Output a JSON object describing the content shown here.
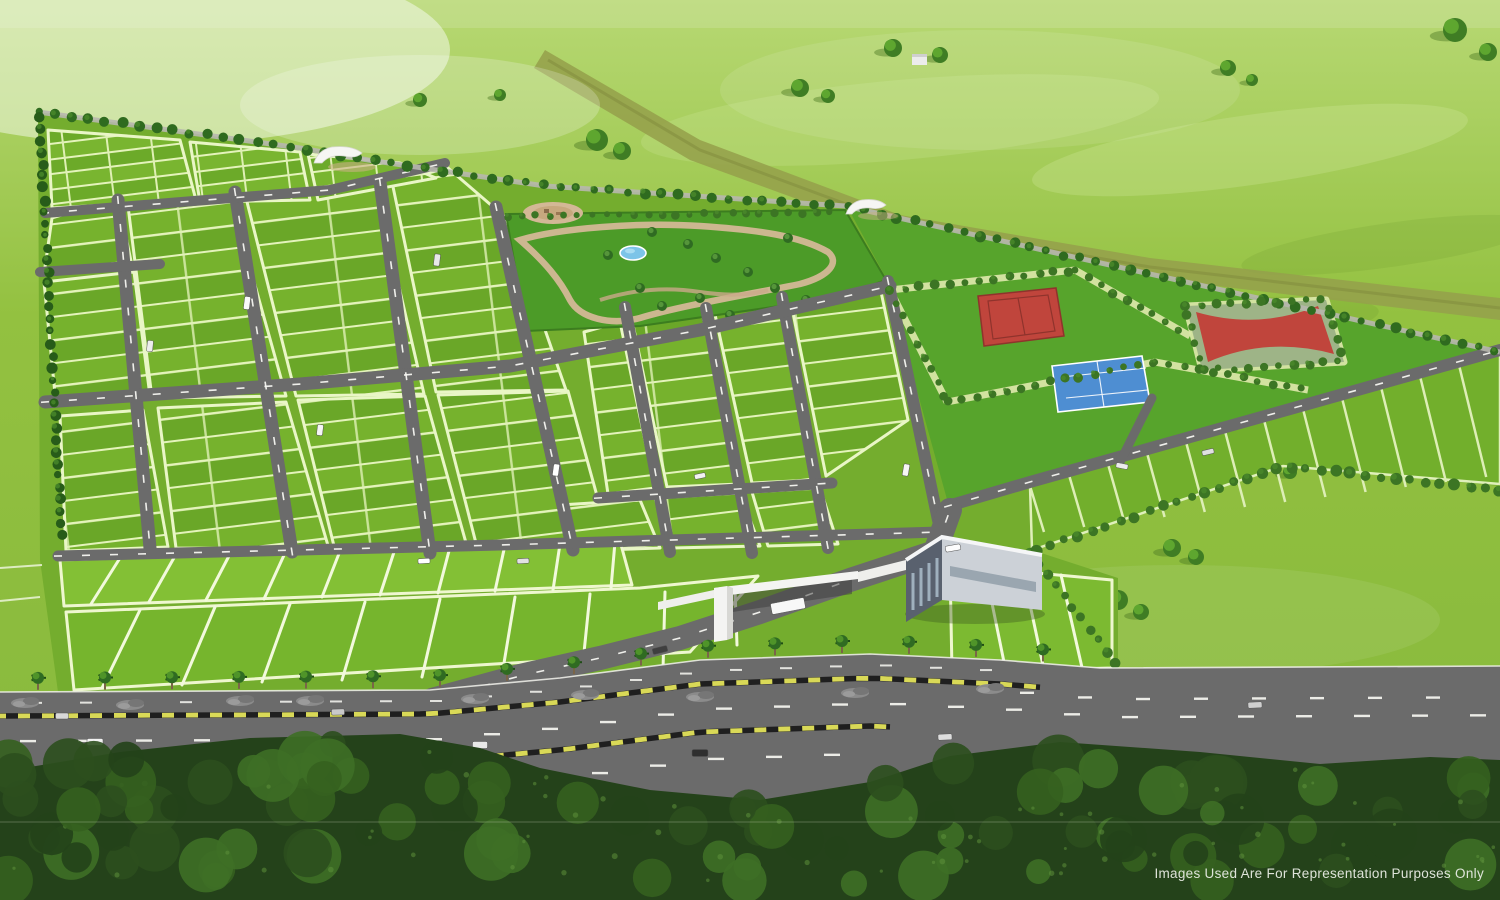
{
  "footer": {
    "disclaimer": "Images Used Are For Representation Purposes Only"
  },
  "palette": {
    "field_top": "#b7d873",
    "field_mid": "#93c140",
    "field_low": "#86b83c",
    "estate_lawn": "#74ad2e",
    "plot_green_a": "#76b22d",
    "plot_green_b": "#6aa728",
    "plot_line": "#e4f3bb",
    "front_plot_a": "#83c035",
    "front_plot_b": "#76b52d",
    "front_plot_c": "#7cba31",
    "se_plot": "#72af2c",
    "road": "#6b6b6b",
    "road_line": "#f7f7f2",
    "boundary_road": "#b7b7ae",
    "boundary_tree": "#2f6b1f",
    "conifer": "#275c19",
    "hedge": "#3c7524",
    "park_green": "#4c9b28",
    "courts_lawn": "#57a42c",
    "path_tan": "#d3b896",
    "plaza_tan": "#c7a87e",
    "pond_blue": "#7cc4e8",
    "court_red": "#c0453c",
    "court_blue": "#4e8ed2",
    "court_rim": "#9eb487",
    "khaki_path": "#d9e6a6",
    "gate_white": "#f4f4f2",
    "clubhouse_dark": "#59616e",
    "clubhouse_light": "#ccd1d7",
    "median_yellow": "#d9d957",
    "median_black": "#1f1f1f",
    "palm_dark": "#2f6b22",
    "palm_light": "#4f9429",
    "trunk": "#7a6548",
    "dirt_band": "#95a04b",
    "forest_0": "#24421a",
    "forest_1": "#2c4f1e",
    "forest_2": "#35611f",
    "forest_3": "#3e6f26",
    "forest_speckle": "#5d8f3b",
    "disclaimer_text": "#e8ece4"
  },
  "scenery": {
    "field_trees": [
      [
        100,
        222,
        10
      ],
      [
        116,
        231,
        8
      ],
      [
        420,
        100,
        7
      ],
      [
        597,
        140,
        11
      ],
      [
        622,
        151,
        9
      ],
      [
        800,
        88,
        9
      ],
      [
        828,
        96,
        7
      ],
      [
        893,
        48,
        9
      ],
      [
        940,
        55,
        8
      ],
      [
        1228,
        68,
        8
      ],
      [
        1252,
        80,
        6
      ],
      [
        1455,
        30,
        12
      ],
      [
        1488,
        52,
        9
      ],
      [
        762,
        296,
        8
      ],
      [
        783,
        304,
        7
      ],
      [
        893,
        284,
        8
      ],
      [
        938,
        333,
        8
      ],
      [
        1118,
        600,
        10
      ],
      [
        1141,
        612,
        8
      ],
      [
        1172,
        548,
        9
      ],
      [
        1196,
        557,
        8
      ],
      [
        1290,
        472,
        7
      ],
      [
        500,
        95,
        6
      ]
    ],
    "park_palms": [
      [
        652,
        232
      ],
      [
        688,
        244
      ],
      [
        716,
        258
      ],
      [
        748,
        272
      ],
      [
        775,
        288
      ],
      [
        700,
        298
      ],
      [
        662,
        306
      ],
      [
        640,
        288
      ],
      [
        788,
        238
      ],
      [
        806,
        300
      ],
      [
        730,
        315
      ],
      [
        608,
        255
      ]
    ],
    "roads": [
      {
        "pts": [
          [
            118,
            200
          ],
          [
            150,
            548
          ]
        ],
        "w": 13,
        "dash": true
      },
      {
        "pts": [
          [
            235,
            192
          ],
          [
            292,
            552
          ]
        ],
        "w": 13,
        "dash": true
      },
      {
        "pts": [
          [
            380,
            182
          ],
          [
            430,
            553
          ]
        ],
        "w": 13,
        "dash": true
      },
      {
        "pts": [
          [
            496,
            207
          ],
          [
            573,
            550
          ]
        ],
        "w": 13,
        "dash": true
      },
      {
        "pts": [
          [
            625,
            307
          ],
          [
            670,
            552
          ]
        ],
        "w": 12,
        "dash": true
      },
      {
        "pts": [
          [
            706,
            308
          ],
          [
            752,
            553
          ]
        ],
        "w": 12,
        "dash": true
      },
      {
        "pts": [
          [
            782,
            297
          ],
          [
            828,
            548
          ]
        ],
        "w": 12,
        "dash": true
      },
      {
        "pts": [
          [
            888,
            281
          ],
          [
            938,
            520
          ]
        ],
        "w": 12,
        "dash": true
      },
      {
        "pts": [
          [
            45,
            213
          ],
          [
            330,
            190
          ],
          [
            445,
            163
          ]
        ],
        "w": 10,
        "dash": true
      },
      {
        "pts": [
          [
            40,
            272
          ],
          [
            160,
            264
          ]
        ],
        "w": 10,
        "dash": false
      },
      {
        "pts": [
          [
            45,
            402
          ],
          [
            300,
            384
          ],
          [
            510,
            366
          ],
          [
            700,
            330
          ],
          [
            890,
            286
          ]
        ],
        "w": 13,
        "dash": true
      },
      {
        "pts": [
          [
            598,
            498
          ],
          [
            832,
            483
          ]
        ],
        "w": 11,
        "dash": true
      },
      {
        "pts": [
          [
            58,
            556
          ],
          [
            500,
            545
          ],
          [
            940,
            532
          ]
        ],
        "w": 11,
        "dash": true
      },
      {
        "pts": [
          [
            948,
            506
          ],
          [
            1030,
            482
          ],
          [
            1500,
            350
          ]
        ],
        "w": 12,
        "dash": true
      },
      {
        "pts": [
          [
            1152,
            398
          ],
          [
            1120,
            462
          ]
        ],
        "w": 9,
        "dash": false
      },
      {
        "pts": [
          [
            432,
            700
          ],
          [
            520,
            676
          ],
          [
            600,
            658
          ],
          [
            680,
            638
          ],
          [
            760,
            612
          ],
          [
            850,
            580
          ],
          [
            935,
            552
          ],
          [
            950,
            510
          ]
        ],
        "w": 24,
        "dash": true
      }
    ],
    "boundary_road": [
      [
        38,
        112
      ],
      [
        300,
        148
      ],
      [
        368,
        160
      ],
      [
        545,
        186
      ],
      [
        845,
        206
      ],
      [
        1500,
        352
      ]
    ],
    "hedgerows": [
      {
        "pts": [
          [
            38,
            112
          ],
          [
            300,
            148
          ],
          [
            368,
            160
          ],
          [
            545,
            186
          ],
          [
            845,
            206
          ],
          [
            1500,
            352
          ]
        ],
        "step": 17,
        "r": 4.5,
        "color": "boundary_tree"
      },
      {
        "pts": [
          [
            40,
            116
          ],
          [
            62,
            545
          ]
        ],
        "step": 12,
        "r": 4.5,
        "color": "conifer"
      },
      {
        "pts": [
          [
            508,
            216
          ],
          [
            843,
            212
          ]
        ],
        "step": 14,
        "r": 3.5,
        "color": "hedge"
      },
      {
        "pts": [
          [
            890,
            290
          ],
          [
            947,
            402
          ]
        ],
        "step": 15,
        "r": 4,
        "color": "hedge",
        "under": true
      },
      {
        "pts": [
          [
            890,
            290
          ],
          [
            1075,
            270
          ]
        ],
        "step": 15,
        "r": 4,
        "color": "hedge",
        "under": true
      },
      {
        "pts": [
          [
            1075,
            270
          ],
          [
            1190,
            336
          ]
        ],
        "step": 15,
        "r": 4,
        "color": "hedge",
        "under": true
      },
      {
        "pts": [
          [
            947,
            402
          ],
          [
            1155,
            362
          ]
        ],
        "step": 15,
        "r": 4,
        "color": "hedge",
        "under": true
      },
      {
        "pts": [
          [
            1155,
            362
          ],
          [
            1308,
            390
          ]
        ],
        "step": 15,
        "r": 4,
        "color": "hedge",
        "under": true
      },
      {
        "pts": [
          [
            1186,
            306
          ],
          [
            1326,
            300
          ],
          [
            1344,
            362
          ],
          [
            1202,
            370
          ],
          [
            1186,
            306
          ]
        ],
        "step": 15,
        "r": 4,
        "color": "hedge",
        "under": true
      },
      {
        "pts": [
          [
            1500,
            490
          ],
          [
            1283,
            466
          ],
          [
            1030,
            552
          ]
        ],
        "step": 15,
        "r": 5,
        "color": "hedge"
      },
      {
        "pts": [
          [
            1030,
            552
          ],
          [
            1118,
            665
          ]
        ],
        "step": 14,
        "r": 4.5,
        "color": "hedge"
      },
      {
        "pts": [
          [
            1065,
            684
          ],
          [
            1500,
            680
          ]
        ],
        "step": 55,
        "r": 7,
        "color": "boundary_tree"
      }
    ],
    "front_separators": [
      [
        120,
        558,
        91,
        604
      ],
      [
        175,
        556,
        149,
        602
      ],
      [
        230,
        554,
        206,
        600
      ],
      [
        285,
        553,
        264,
        599
      ],
      [
        340,
        551,
        322,
        597
      ],
      [
        395,
        549,
        380,
        595
      ],
      [
        450,
        547,
        438,
        593
      ],
      [
        505,
        545,
        495,
        591
      ],
      [
        560,
        544,
        553,
        590
      ],
      [
        615,
        542,
        611,
        588
      ],
      [
        140,
        610,
        102,
        688
      ],
      [
        215,
        607,
        182,
        685
      ],
      [
        290,
        604,
        262,
        682
      ],
      [
        365,
        602,
        342,
        680
      ],
      [
        440,
        599,
        422,
        677
      ],
      [
        515,
        597,
        502,
        675
      ],
      [
        590,
        594,
        582,
        672
      ],
      [
        665,
        592,
        663,
        670
      ],
      [
        735,
        589,
        737,
        645
      ],
      [
        985,
        569,
        1005,
        667
      ],
      [
        1023,
        572,
        1044,
        670
      ],
      [
        1061,
        575,
        1083,
        672
      ]
    ],
    "vehicles": [
      [
        95,
        742,
        16,
        7,
        0,
        "#f2f2f2"
      ],
      [
        255,
        748,
        15,
        7,
        0,
        "#3a3a3a"
      ],
      [
        480,
        745,
        15,
        7,
        0,
        "#e8e8e8"
      ],
      [
        700,
        753,
        16,
        7,
        0,
        "#2f2f2f"
      ],
      [
        945,
        737,
        14,
        6,
        -2,
        "#dddddd"
      ],
      [
        1255,
        705,
        14,
        6,
        -3,
        "#cfcfcf"
      ],
      [
        62,
        716,
        13,
        6,
        0,
        "#d8d8d8"
      ],
      [
        338,
        712,
        13,
        6,
        -1,
        "#c9c9c9"
      ],
      [
        660,
        650,
        15,
        6,
        -14,
        "#3f3f3f"
      ],
      [
        788,
        606,
        34,
        11,
        -11,
        "#f8f8f8"
      ],
      [
        953,
        548,
        15,
        6,
        -10,
        "#fdfdfd"
      ],
      [
        247,
        303,
        6,
        13,
        7,
        "#fafafa"
      ],
      [
        437,
        260,
        6,
        12,
        7,
        "#e8e8e8"
      ],
      [
        556,
        470,
        6,
        12,
        8,
        "#ffffff"
      ],
      [
        700,
        476,
        11,
        5,
        -12,
        "#f2f2f2"
      ],
      [
        424,
        561,
        12,
        5,
        -3,
        "#ffffff"
      ],
      [
        523,
        561,
        12,
        5,
        -3,
        "#e2e2e2"
      ],
      [
        906,
        470,
        6,
        12,
        10,
        "#f6f6f6"
      ],
      [
        1122,
        466,
        12,
        5,
        11,
        "#ececec"
      ],
      [
        1208,
        452,
        12,
        5,
        -13,
        "#e0e0e0"
      ],
      [
        150,
        346,
        6,
        11,
        6,
        "#ededed"
      ],
      [
        320,
        430,
        6,
        11,
        7,
        "#f5f5f5"
      ]
    ],
    "highway": {
      "top_edge": [
        [
          0,
          692
        ],
        [
          430,
          690
        ],
        [
          560,
          678
        ],
        [
          700,
          660
        ],
        [
          870,
          654
        ],
        [
          1000,
          660
        ],
        [
          1100,
          668
        ],
        [
          1500,
          666
        ]
      ],
      "palm_x_start": 38,
      "palm_x_end": 1045,
      "palm_step": 67,
      "rocks": [
        [
          25,
          703
        ],
        [
          130,
          705
        ],
        [
          310,
          701
        ],
        [
          475,
          699
        ],
        [
          700,
          697
        ],
        [
          855,
          693
        ],
        [
          240,
          701
        ],
        [
          585,
          695
        ],
        [
          990,
          689
        ]
      ]
    },
    "forest_top": [
      [
        0,
        772
      ],
      [
        120,
        752
      ],
      [
        250,
        738
      ],
      [
        400,
        734
      ],
      [
        480,
        748
      ],
      [
        540,
        768
      ],
      [
        650,
        790
      ],
      [
        760,
        800
      ],
      [
        870,
        782
      ],
      [
        950,
        756
      ],
      [
        1060,
        742
      ],
      [
        1200,
        752
      ],
      [
        1320,
        764
      ],
      [
        1430,
        757
      ],
      [
        1500,
        760
      ]
    ],
    "dirt_band": [
      [
        545,
        50
      ],
      [
        700,
        140
      ],
      [
        900,
        215
      ],
      [
        1150,
        258
      ],
      [
        1500,
        298
      ],
      [
        1500,
        320
      ],
      [
        1150,
        278
      ],
      [
        893,
        234
      ],
      [
        690,
        160
      ],
      [
        534,
        68
      ]
    ]
  }
}
